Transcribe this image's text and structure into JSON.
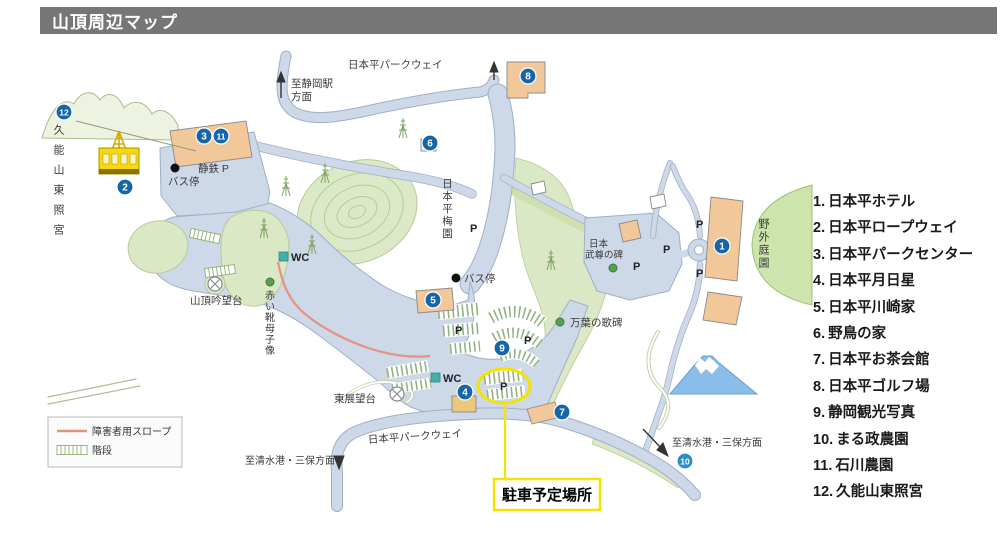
{
  "title": "山頂周辺マップ",
  "legend_panel": {
    "items": [
      {
        "num": "1.",
        "label": "日本平ホテル"
      },
      {
        "num": "2.",
        "label": "日本平ロープウェイ"
      },
      {
        "num": "3.",
        "label": "日本平パークセンター"
      },
      {
        "num": "4.",
        "label": "日本平月日星"
      },
      {
        "num": "5.",
        "label": "日本平川崎家"
      },
      {
        "num": "6.",
        "label": "野鳥の家"
      },
      {
        "num": "7.",
        "label": "日本平お茶会館"
      },
      {
        "num": "8.",
        "label": "日本平ゴルフ場"
      },
      {
        "num": "9.",
        "label": "静岡観光写真"
      },
      {
        "num": "10.",
        "label": "まる政農園"
      },
      {
        "num": "11.",
        "label": "石川農園"
      },
      {
        "num": "12.",
        "label": "久能山東照宮"
      }
    ]
  },
  "map": {
    "labels": {
      "parkway_top": "日本平パークウェイ",
      "parkway_bottom": "日本平パークウェイ",
      "to_shizuoka_1": "至静岡駅",
      "to_shizuoka_2": "方面",
      "to_shimizu_left": "至清水港・三保方面",
      "to_shimizu_right": "至清水港・三保方面",
      "kunozan": "久能山東照宮",
      "baien": "日本平梅園",
      "shizutetsu_p": "静鉄 P",
      "bus_stop_top": "バス停",
      "bus_stop_center": "バス停",
      "wc": "WC",
      "gimbodai": "山頂吟望台",
      "akaikutsu": "赤い靴母子像",
      "manyo": "万葉の歌碑",
      "takeru_1": "日本",
      "takeru_2": "武尊の碑",
      "yagai_teien": "野外庭園",
      "higashi_tembodai": "東展望台",
      "p": "P",
      "parking_plan": "駐車予定場所"
    },
    "markers": {
      "m1": "1",
      "m2": "2",
      "m3": "3",
      "m4": "4",
      "m5": "5",
      "m6": "6",
      "m7": "7",
      "m8": "8",
      "m9": "9",
      "m10": "10",
      "m11": "11",
      "m12": "12"
    },
    "legend_box": {
      "slope": "障害者用スロープ",
      "stairs": "階段"
    },
    "colors": {
      "road": "#cdd8e8",
      "road_outline": "#9fb0c6",
      "green_area": "#dbe8c6",
      "building_orange": "#f2c89b",
      "marker_blue": "#1565a8",
      "highlight_yellow": "#f2e400",
      "title_bar_gray": "#767676",
      "slope_red": "#e59380",
      "wc_teal": "#43b0a8",
      "fuji_blue": "#8abde9"
    }
  }
}
